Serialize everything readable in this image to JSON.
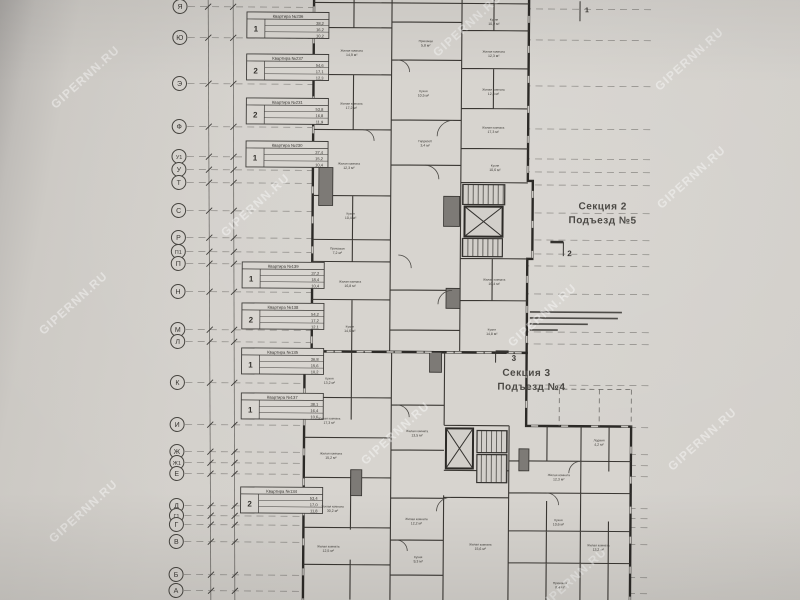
{
  "watermark": {
    "text": "GIPERNN.RU",
    "color": "#ffffff",
    "positions": [
      {
        "x": 88,
        "y": 80
      },
      {
        "x": 76,
        "y": 306
      },
      {
        "x": 86,
        "y": 514
      },
      {
        "x": 258,
        "y": 208
      },
      {
        "x": 398,
        "y": 436
      },
      {
        "x": 470,
        "y": 28
      },
      {
        "x": 545,
        "y": 318
      },
      {
        "x": 575,
        "y": 582
      },
      {
        "x": 692,
        "y": 62
      },
      {
        "x": 694,
        "y": 180
      },
      {
        "x": 705,
        "y": 442
      }
    ]
  },
  "axes": {
    "items": [
      {
        "letter": "Я",
        "y": 8
      },
      {
        "letter": "Ю",
        "y": 39
      },
      {
        "letter": "Э",
        "y": 85
      },
      {
        "letter": "Ф",
        "y": 128
      },
      {
        "letter": "У1",
        "y": 158
      },
      {
        "letter": "У",
        "y": 171
      },
      {
        "letter": "Т",
        "y": 184
      },
      {
        "letter": "С",
        "y": 212
      },
      {
        "letter": "Р",
        "y": 239
      },
      {
        "letter": "П1",
        "y": 253
      },
      {
        "letter": "П",
        "y": 265
      },
      {
        "letter": "Н",
        "y": 293
      },
      {
        "letter": "М",
        "y": 331
      },
      {
        "letter": "Л",
        "y": 343
      },
      {
        "letter": "К",
        "y": 384
      },
      {
        "letter": "И",
        "y": 426
      },
      {
        "letter": "Ж",
        "y": 453
      },
      {
        "letter": "Ж1",
        "y": 464
      },
      {
        "letter": "Е",
        "y": 475
      },
      {
        "letter": "Д",
        "y": 507
      },
      {
        "letter": "Г1",
        "y": 517
      },
      {
        "letter": "Г",
        "y": 526
      },
      {
        "letter": "В",
        "y": 543
      },
      {
        "letter": "Б",
        "y": 576
      },
      {
        "letter": "А",
        "y": 592
      }
    ]
  },
  "stamps": {
    "items": [
      {
        "rooms": "1",
        "title": "Квартира №236",
        "areas": [
          "38,2",
          "16,2",
          "10,2"
        ],
        "x": 245,
        "y": 13
      },
      {
        "rooms": "2",
        "title": "Квартира №237",
        "areas": [
          "54,6",
          "17,1",
          "12,3"
        ],
        "x": 245,
        "y": 55
      },
      {
        "rooms": "2",
        "title": "Квартира №231",
        "areas": [
          "53,8",
          "16,8",
          "11,9"
        ],
        "x": 245,
        "y": 99
      },
      {
        "rooms": "1",
        "title": "Квартира №230",
        "areas": [
          "37,4",
          "15,2",
          "10,4"
        ],
        "x": 245,
        "y": 142
      },
      {
        "rooms": "1",
        "title": "Квартира №139",
        "areas": [
          "37,2",
          "18,4",
          "10,4"
        ],
        "x": 242,
        "y": 263
      },
      {
        "rooms": "2",
        "title": "Квартира №138",
        "areas": [
          "54,2",
          "17,2",
          "12,1"
        ],
        "x": 242,
        "y": 304
      },
      {
        "rooms": "1",
        "title": "Квартира №135",
        "areas": [
          "36,8",
          "15,6",
          "10,2"
        ],
        "x": 242,
        "y": 349
      },
      {
        "rooms": "1",
        "title": "Квартира №137",
        "areas": [
          "38,1",
          "16,4",
          "10,6"
        ],
        "x": 242,
        "y": 394
      },
      {
        "rooms": "2",
        "title": "Квартира №134",
        "areas": [
          "53,4",
          "17,0",
          "11,8"
        ],
        "x": 242,
        "y": 488
      }
    ]
  },
  "sections": {
    "section2": {
      "line1": "Секция 2",
      "line2": "Подъезд №5"
    },
    "section3": {
      "line1": "Секция 3",
      "line2": "Подъезд №4"
    }
  },
  "cut_marks": [
    {
      "label": "1"
    },
    {
      "label": "2"
    },
    {
      "label": "3"
    }
  ],
  "room_labels": [
    {
      "n": "Жилая комната",
      "a": "14,9 м²",
      "x": 350,
      "y": 52
    },
    {
      "n": "Жилая комната",
      "a": "17,2 м²",
      "x": 350,
      "y": 105
    },
    {
      "n": "Жилая комната",
      "a": "12,3 м²",
      "x": 348,
      "y": 165
    },
    {
      "n": "Кухня",
      "a": "10,4 м²",
      "x": 350,
      "y": 215
    },
    {
      "n": "Прихожая",
      "a": "7,2 м²",
      "x": 337,
      "y": 250
    },
    {
      "n": "Жилая комната",
      "a": "16,8 м²",
      "x": 350,
      "y": 283
    },
    {
      "n": "Кухня",
      "a": "14,6 м²",
      "x": 350,
      "y": 328
    },
    {
      "n": "Прихожая",
      "a": "5,8 м²",
      "x": 424,
      "y": 42
    },
    {
      "n": "Кухня",
      "a": "10,5 м²",
      "x": 422,
      "y": 92
    },
    {
      "n": "Гардероб",
      "a": "3,4 м²",
      "x": 424,
      "y": 142
    },
    {
      "n": "Кухня",
      "a": "10,2 м²",
      "x": 492,
      "y": 20
    },
    {
      "n": "Жилая комната",
      "a": "12,3 м²",
      "x": 492,
      "y": 52
    },
    {
      "n": "Жилая комната",
      "a": "12,3 м²",
      "x": 492,
      "y": 90
    },
    {
      "n": "Жилая комната",
      "a": "17,3 м²",
      "x": 492,
      "y": 128
    },
    {
      "n": "Кухня",
      "a": "10,6 м²",
      "x": 494,
      "y": 166
    },
    {
      "n": "Жилая комната",
      "a": "16,4 м²",
      "x": 494,
      "y": 280
    },
    {
      "n": "Кухня",
      "a": "14,8 м²",
      "x": 492,
      "y": 330
    },
    {
      "n": "Кухня",
      "a": "13,2 м²",
      "x": 330,
      "y": 380
    },
    {
      "n": "Жилая комната",
      "a": "17,3 м²",
      "x": 330,
      "y": 420
    },
    {
      "n": "Жилая комната",
      "a": "15,2 м²",
      "x": 332,
      "y": 455
    },
    {
      "n": "Жилая комната",
      "a": "30,2 м²",
      "x": 334,
      "y": 508
    },
    {
      "n": "Жилая комната",
      "a": "12,5 м²",
      "x": 330,
      "y": 548
    },
    {
      "n": "Жилая комната",
      "a": "13,5 м²",
      "x": 418,
      "y": 432
    },
    {
      "n": "Жилая комната",
      "a": "12,2 м²",
      "x": 418,
      "y": 520
    },
    {
      "n": "Кухня",
      "a": "9,3 м²",
      "x": 420,
      "y": 558
    },
    {
      "n": "Жилая комната",
      "a": "15,6 м²",
      "x": 482,
      "y": 545
    },
    {
      "n": "Жилая комната",
      "a": "12,3 м²",
      "x": 560,
      "y": 475
    },
    {
      "n": "Кухня",
      "a": "10,6 м²",
      "x": 560,
      "y": 520
    },
    {
      "n": "Жилая комната",
      "a": "13,2 м²",
      "x": 600,
      "y": 545
    },
    {
      "n": "Прихожая",
      "a": "8,4 м²",
      "x": 562,
      "y": 583
    },
    {
      "n": "Лоджия",
      "a": "4,2 м²",
      "x": 600,
      "y": 440
    }
  ],
  "colors": {
    "paper": "#d5d2cd",
    "plan_fill": "#d7d4cf",
    "ink": "#33312d",
    "wall": "#2c2a27",
    "dash": "#716f6b"
  }
}
